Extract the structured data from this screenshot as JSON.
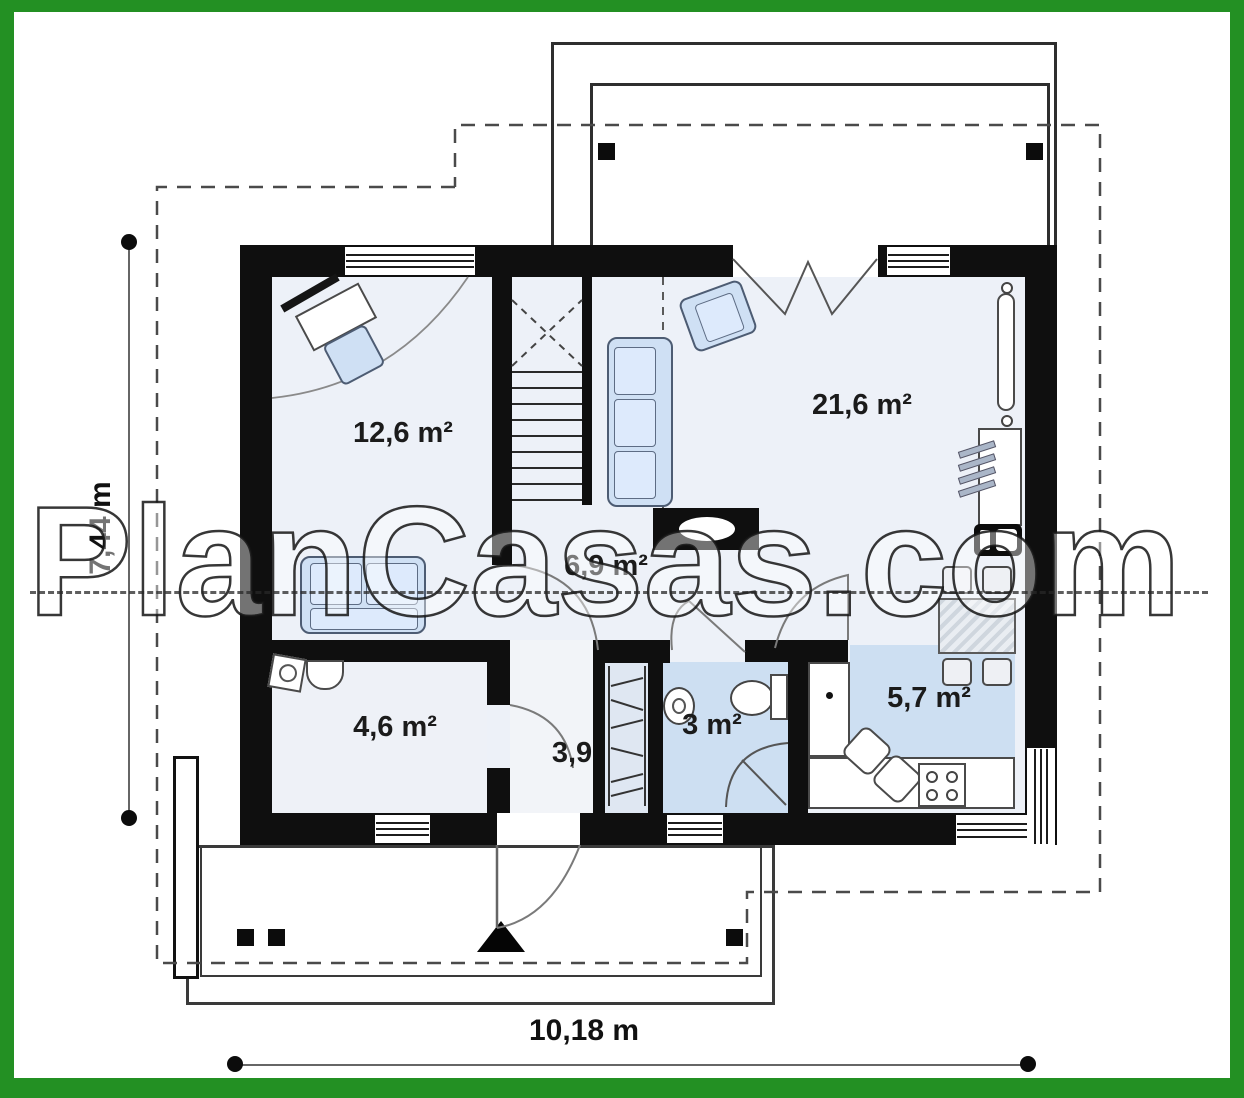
{
  "watermark": {
    "text": "PlanCasas.com"
  },
  "plan": {
    "type": "floor-plan",
    "rooms": {
      "bedroom": {
        "label": "12,6 m²"
      },
      "living": {
        "label": "21,6 m²"
      },
      "hall": {
        "label": "6,9 m²"
      },
      "bathroom": {
        "label": "4,6 m²"
      },
      "entry": {
        "label": "3,9"
      },
      "wc": {
        "label": "3 m²"
      },
      "kitchen": {
        "label": "5,7 m²"
      }
    },
    "dimensions": {
      "height": "7,44 m",
      "width": "10,18 m"
    }
  },
  "colors": {
    "frame": "#239023",
    "wall": "#0f0f0f",
    "room_fill": "#edf1f8",
    "highlight_fill": "#cddff2",
    "furniture_fill": "#cfe0f4",
    "line": "#4a4a4a"
  }
}
